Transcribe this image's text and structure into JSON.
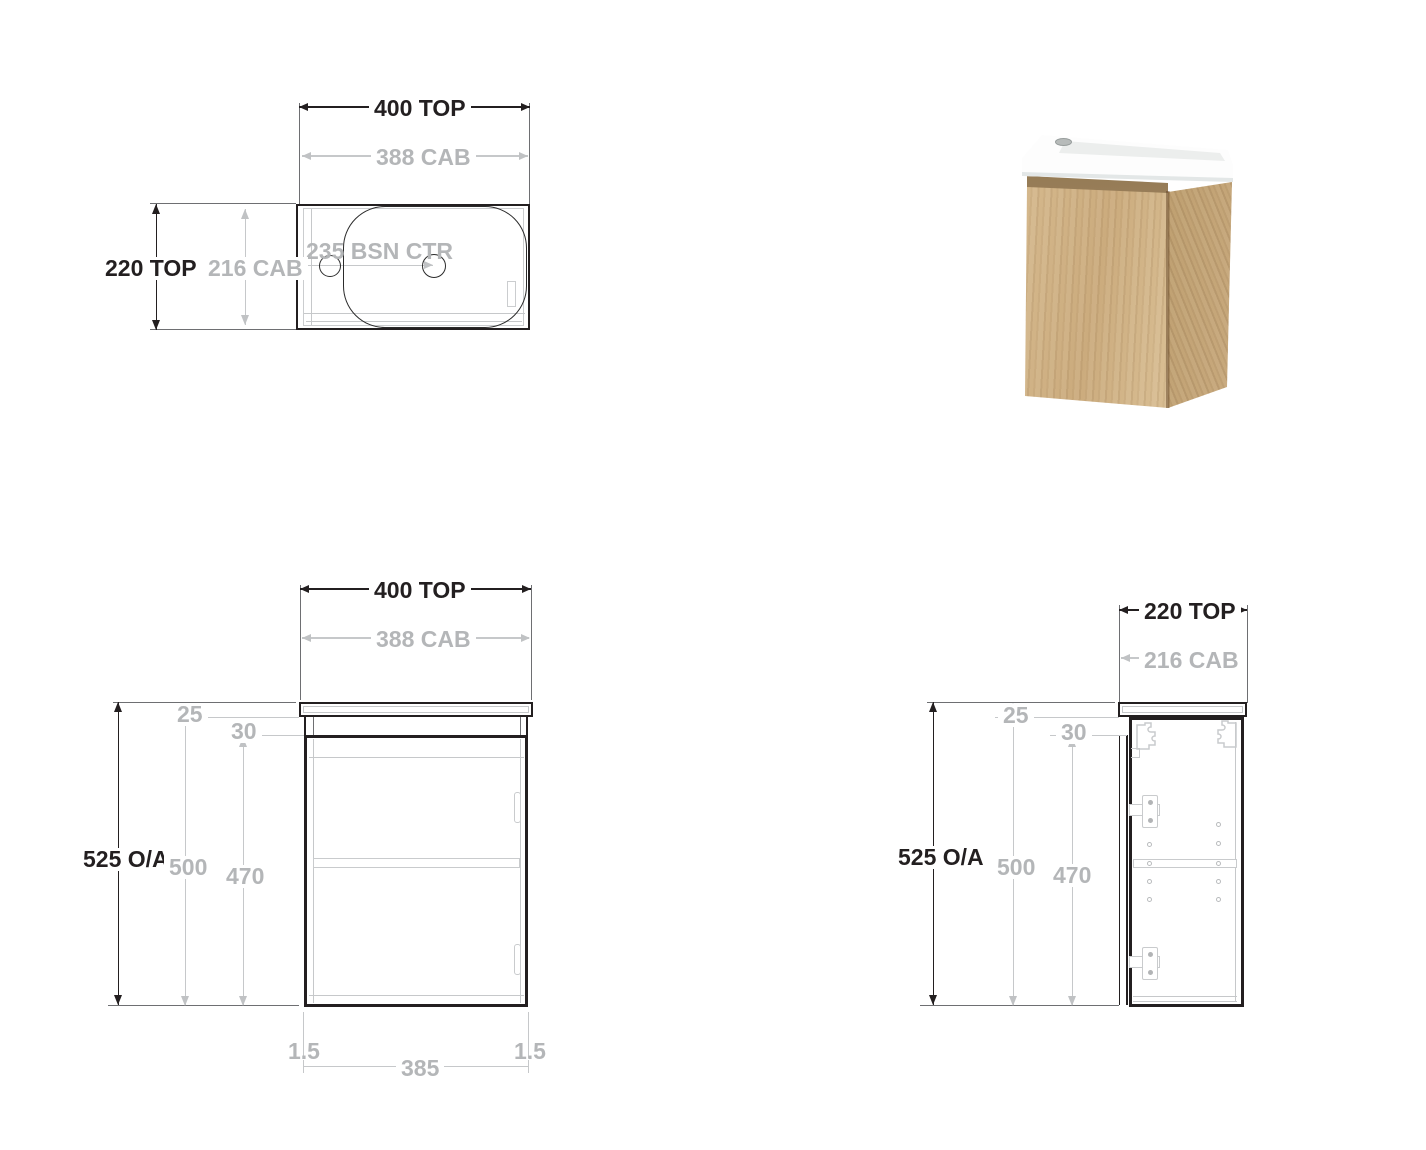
{
  "title": "Wall-hung vanity technical drawing",
  "colors": {
    "line_dark": "#231f20",
    "line_gray": "#c6c8ca",
    "text_dark": "#231f20",
    "text_gray": "#b4b6b8",
    "wood": "#cdb087",
    "basin": "#ffffff"
  },
  "views": {
    "plan": {
      "dims": {
        "top_width": "400 TOP",
        "cab_width": "388 CAB",
        "top_depth": "220 TOP",
        "cab_depth": "216 CAB",
        "basin_centre": "235 BSN CTR"
      }
    },
    "front": {
      "dims": {
        "top_width": "400 TOP",
        "cab_width": "388 CAB",
        "overall_height": "525 O/A",
        "top_thickness": "25",
        "door_offset": "30",
        "cab_height": "500",
        "door_height": "470",
        "gap_left": "1.5",
        "door_width": "385",
        "gap_right": "1.5"
      }
    },
    "side": {
      "dims": {
        "top_depth": "220 TOP",
        "cab_depth": "216 CAB",
        "overall_height": "525 O/A",
        "top_thickness": "25",
        "door_offset": "30",
        "cab_height": "500",
        "door_height": "470"
      }
    }
  }
}
